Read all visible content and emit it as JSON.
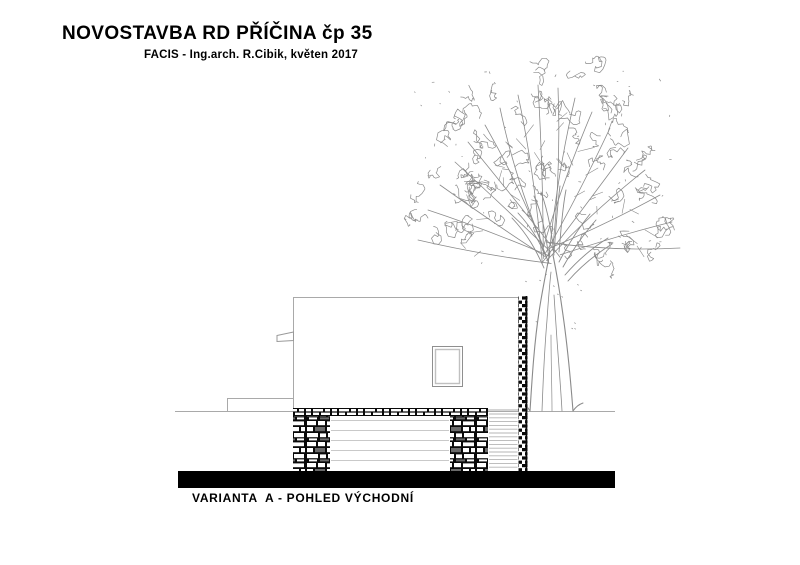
{
  "header": {
    "title": "NOVOSTAVBA RD PŘÍČINA čp 35",
    "subtitle": "FACIS - Ing.arch. R.Cibik, květen 2017"
  },
  "caption": {
    "label": "VARIANTA  A - POHLED VÝCHODNÍ"
  },
  "drawing": {
    "view": "east elevation, variant A",
    "elements": [
      "house-main-volume",
      "window",
      "roof-spout",
      "masonry-lintel",
      "masonry-pier-left",
      "masonry-pier-right",
      "garage-door",
      "louver-screen",
      "stone-column",
      "terrain-step",
      "ground-line",
      "ground-bar",
      "tree"
    ],
    "colors": {
      "ink": "#000000",
      "paper": "#ffffff",
      "wall_line": "#a9a9a9",
      "door_line": "#c9c9c9",
      "louver_line": "#b5b5b5",
      "tree_line": "#8a8a8a",
      "stone_mortar": "#0a0a0a",
      "stone_gray": "#6a6a6a",
      "ground_bar": "#000000"
    }
  }
}
